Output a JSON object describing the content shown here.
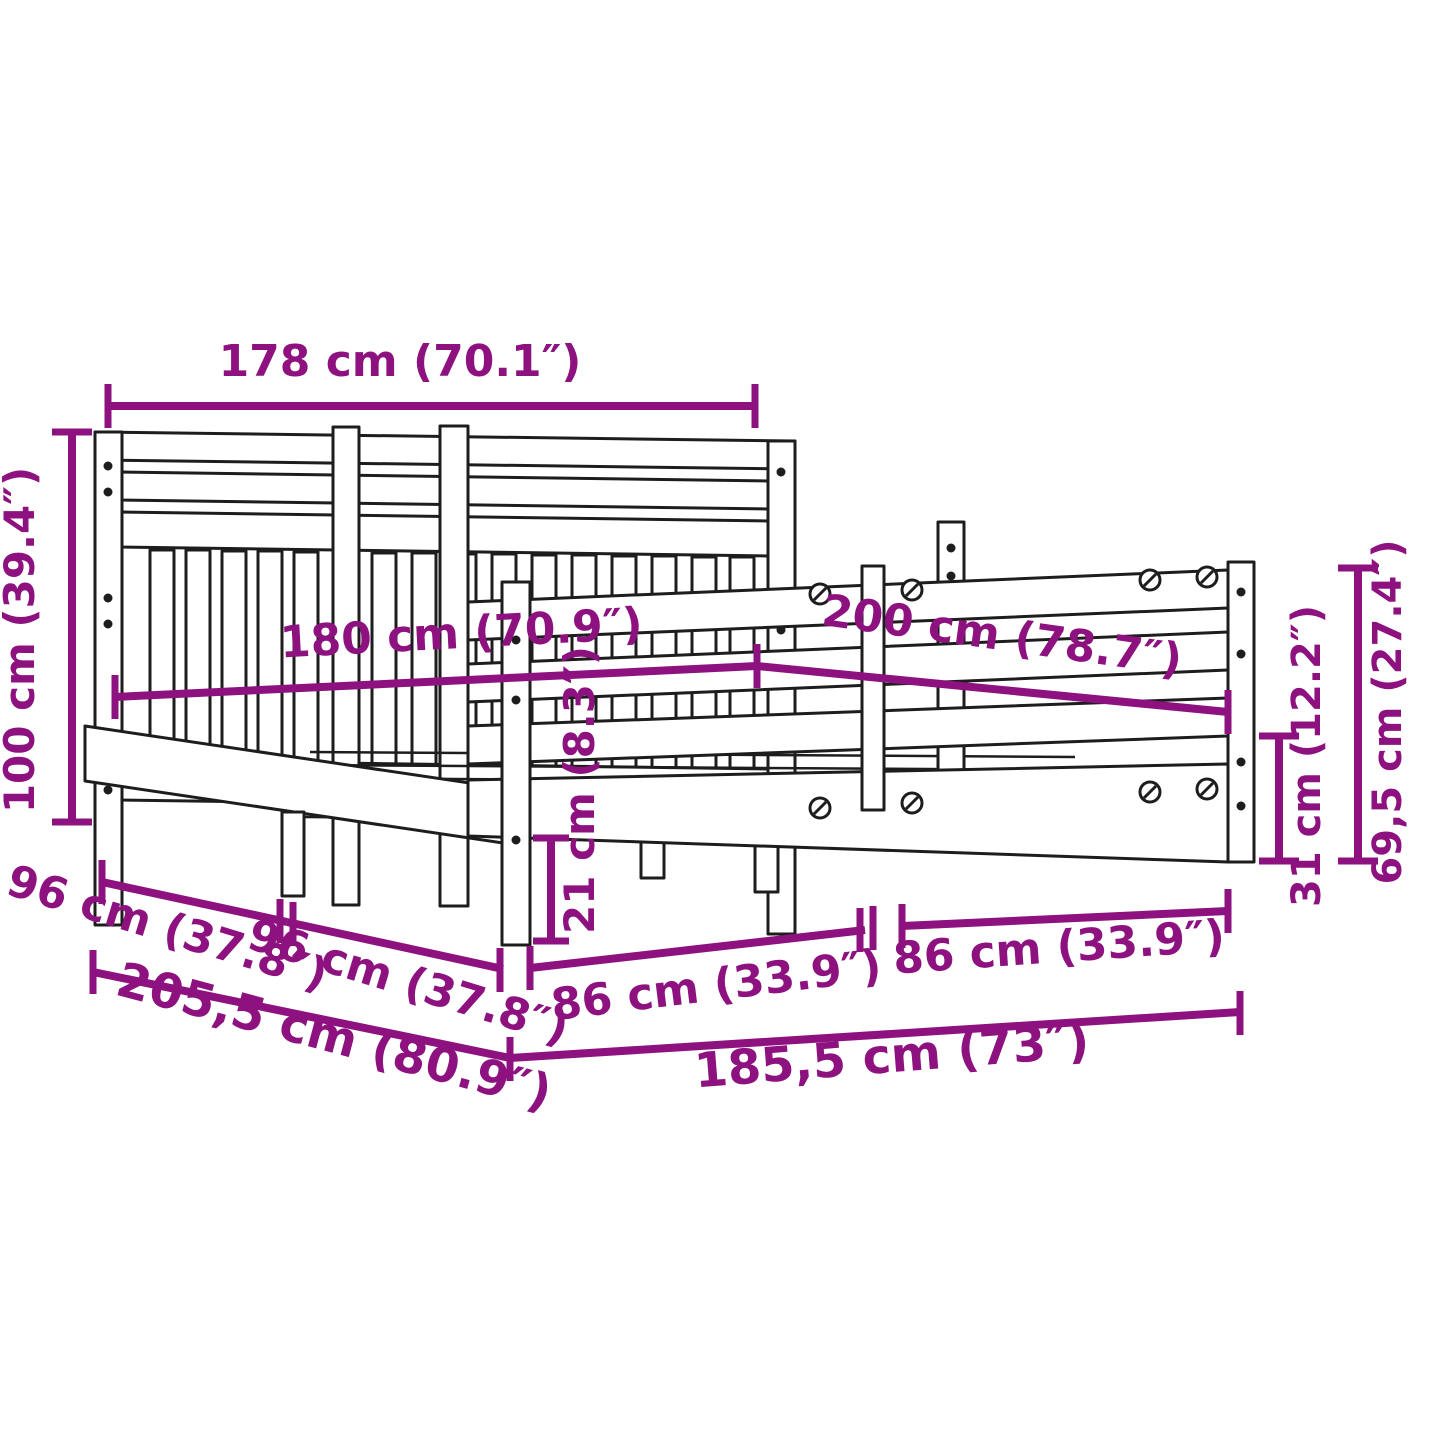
{
  "diagram": {
    "subject": "bed-frame-with-headboard-dimension-diagram",
    "accent_color": "#8d1280",
    "line_color": "#1d1d1d",
    "background_color": "#ffffff",
    "dimensions": {
      "headboard_width": "178 cm (70.1″)",
      "headboard_height": "100 cm (39.4″)",
      "bed_width": "180 cm (70.9″)",
      "bed_length": "200 cm (78.7″)",
      "side_section_1": "96 cm (37.8″)",
      "side_section_2": "96 cm (37.8″)",
      "total_length": "205,5 cm (80.9″)",
      "front_section_1": "86 cm (33.9″)",
      "front_section_2": "86 cm (33.9″)",
      "total_width": "185,5 cm (73″)",
      "clearance_height": "21 cm (8.3″)",
      "side_rail_height": "31 cm (12.2″)",
      "end_height": "69,5 cm (27.4″)"
    }
  }
}
